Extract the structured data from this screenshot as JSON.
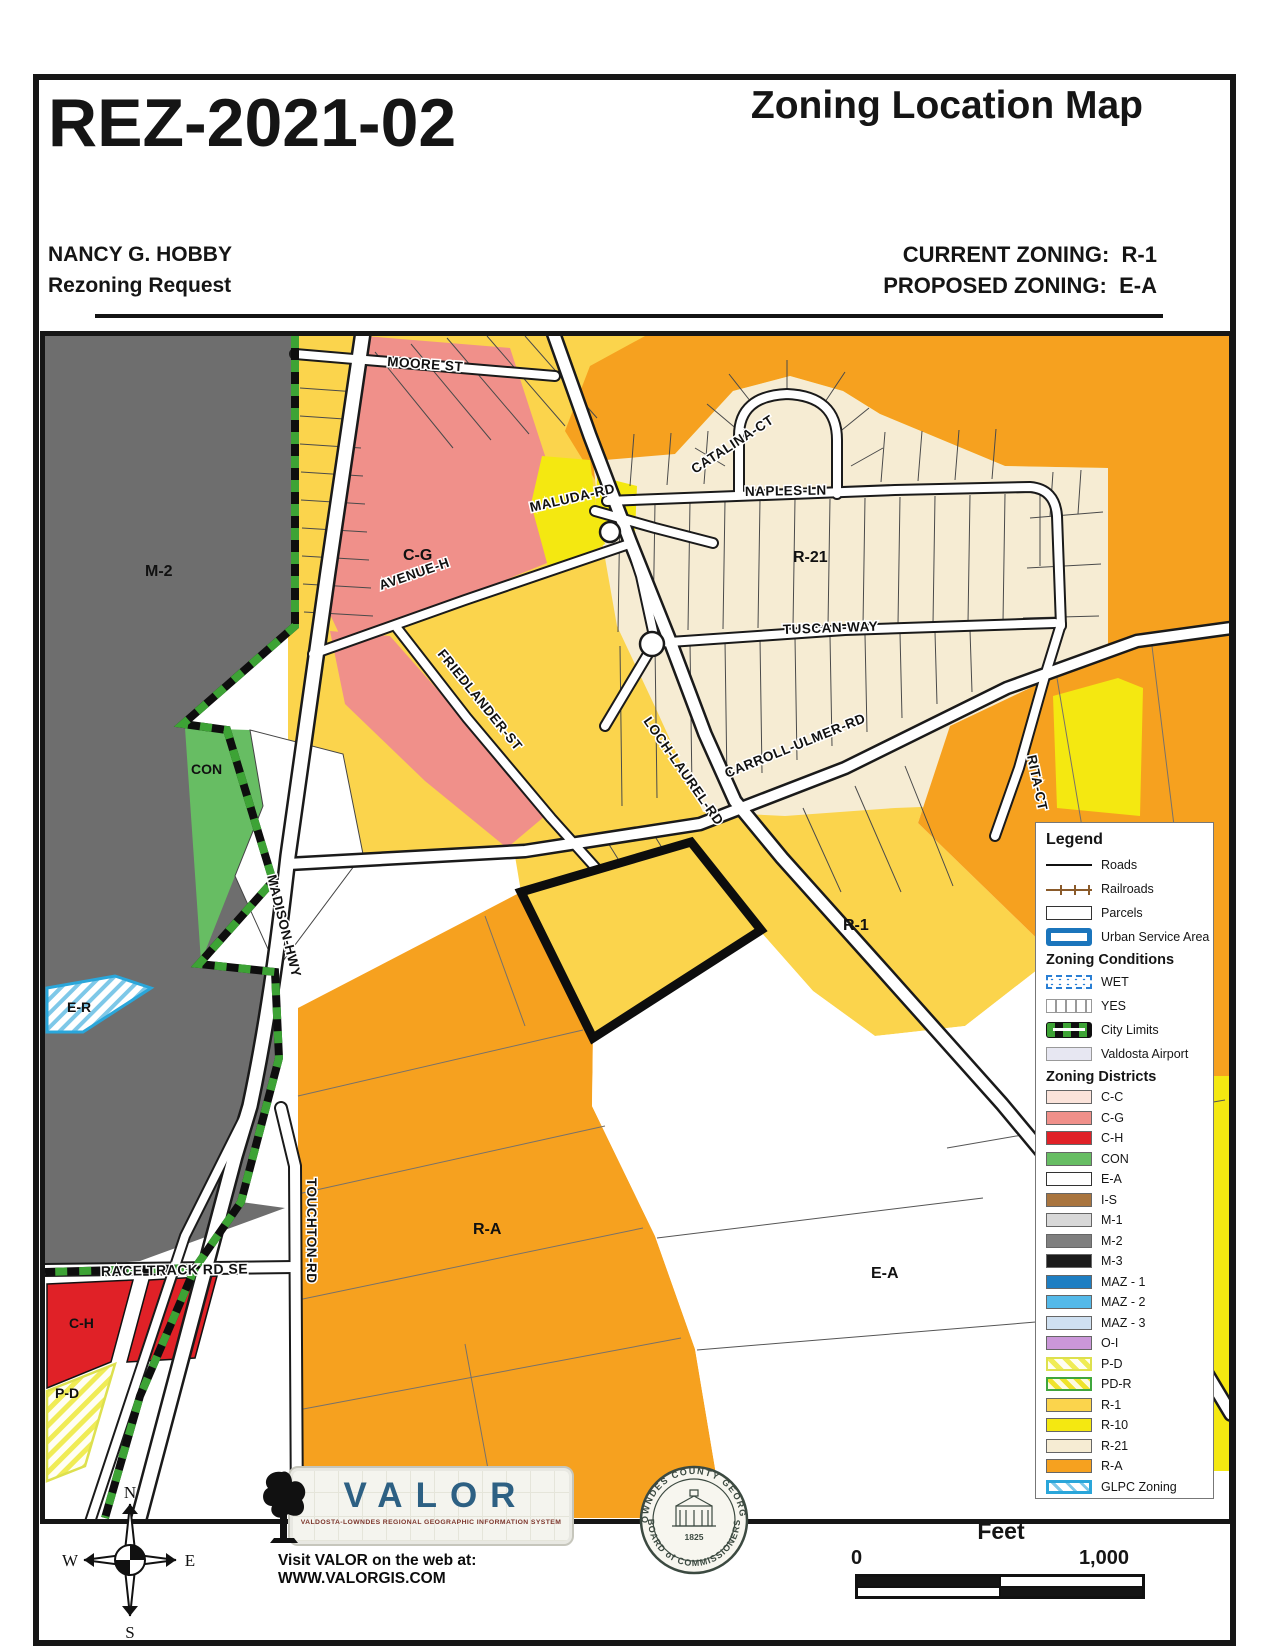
{
  "header": {
    "case_number": "REZ-2021-02",
    "title": "Zoning Location Map",
    "applicant": "NANCY G. HOBBY",
    "request": "Rezoning Request",
    "current_label": "CURRENT ZONING:",
    "current_value": "R-1",
    "proposed_label": "PROPOSED ZONING:",
    "proposed_value": "E-A"
  },
  "map": {
    "streets": {
      "moore": "MOORE ST",
      "catalina": "CATALINA-CT",
      "maluda": "MALUDA-RD",
      "naples": "NAPLES-LN",
      "tuscan": "TUSCAN-WAY",
      "avenue_h": "AVENUE-H",
      "friedlander": "FRIEDLANDER-ST",
      "carroll_ulmer": "CARROLL-ULMER-RD",
      "loch_laurel": "LOCH-LAUREL-RD",
      "madison": "MADISON-HWY",
      "rita": "RITA-CT",
      "touchton": "TOUCHTON-RD",
      "race_track": "RACE TRACK RD SE"
    },
    "zones": {
      "m2": "M-2",
      "cg": "C-G",
      "con": "CON",
      "er": "E-R",
      "r21": "R-21",
      "r1": "R-1",
      "ra": "R-A",
      "ea": "E-A",
      "ch": "C-H",
      "pd": "P-D"
    }
  },
  "legend": {
    "title": "Legend",
    "items": [
      {
        "label": "Roads"
      },
      {
        "label": "Railroads"
      },
      {
        "label": "Parcels"
      },
      {
        "label": "Urban Service Area"
      }
    ],
    "conditions_title": "Zoning Conditions",
    "conditions": [
      {
        "label": "WET"
      },
      {
        "label": "YES"
      },
      {
        "label": "City Limits"
      },
      {
        "label": "Valdosta Airport"
      }
    ],
    "districts_title": "Zoning Districts",
    "districts": [
      {
        "label": "C-C",
        "color": "#fbe3da"
      },
      {
        "label": "C-G",
        "color": "#f0908a"
      },
      {
        "label": "C-H",
        "color": "#e02127"
      },
      {
        "label": "CON",
        "color": "#67bd63"
      },
      {
        "label": "E-A",
        "color": "#ffffff"
      },
      {
        "label": "I-S",
        "color": "#a9753f"
      },
      {
        "label": "M-1",
        "color": "#d8d8d8"
      },
      {
        "label": "M-2",
        "color": "#7f7f7f"
      },
      {
        "label": "M-3",
        "color": "#1b1b1b"
      },
      {
        "label": "MAZ - 1",
        "color": "#1e7ec2"
      },
      {
        "label": "MAZ - 2",
        "color": "#54b9e9"
      },
      {
        "label": "MAZ - 3",
        "color": "#cfe0f1"
      },
      {
        "label": "O-I",
        "color": "#cb97d9"
      },
      {
        "label": "P-D"
      },
      {
        "label": "PD-R"
      },
      {
        "label": "R-1",
        "color": "#fbd44c"
      },
      {
        "label": "R-10",
        "color": "#f4e811"
      },
      {
        "label": "R-21",
        "color": "#f6ecd3"
      },
      {
        "label": "R-A",
        "color": "#f6a11f"
      },
      {
        "label": "GLPC Zoning"
      }
    ]
  },
  "footer": {
    "compass": {
      "n": "N",
      "e": "E",
      "s": "S",
      "w": "W"
    },
    "valor": {
      "name": "VALOR",
      "subtitle": "VALDOSTA-LOWNDES REGIONAL GEOGRAPHIC INFORMATION SYSTEM",
      "web": "Visit VALOR on the web at: WWW.VALORGIS.COM"
    },
    "seal": {
      "arc_top": "LOWNDES COUNTY GEORGIA",
      "arc_bottom": "BOARD of COMMISSIONERS",
      "year": "1825"
    },
    "scale": {
      "title": "Feet",
      "start": "0",
      "end": "1,000"
    }
  },
  "colors": {
    "r1": "#fbd44c",
    "r10": "#f4e811",
    "r21": "#f6ecd3",
    "ra": "#f6a11f",
    "cg": "#f0908a",
    "ch": "#e02127",
    "con": "#67bd63",
    "m2": "#6e6e6e",
    "ea": "#ffffff",
    "glpc_blue": "#2aa6da",
    "city_green": "#3da335",
    "usa_blue": "#1b75bc",
    "rail_brown": "#8a5a2a",
    "valor_blue": "#2d6083"
  }
}
